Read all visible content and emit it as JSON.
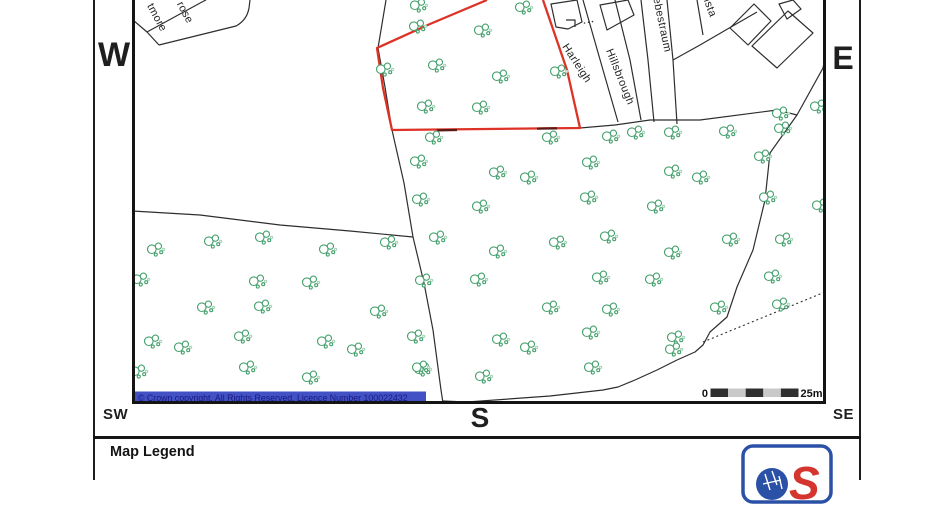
{
  "compass": {
    "west": "W",
    "east": "E",
    "south": "S",
    "southwest": "SW",
    "southeast": "SE"
  },
  "map": {
    "copyright": "© Crown copyright. All Rights Reserved. Licence Number 100022432",
    "scale_bar": {
      "start_label": "0",
      "end_label": "25m",
      "segments": 5
    },
    "street_labels": [
      {
        "text": "tmore"
      },
      {
        "text": "rose"
      },
      {
        "text": "Harleigh"
      },
      {
        "text": "Hillsbrough"
      },
      {
        "text": "Liebestraum"
      },
      {
        "text": "ista"
      }
    ],
    "colors": {
      "boundary": "#dd3327",
      "boundary_dash": "#5c1a14",
      "tree": "#44a06c",
      "tree_light": "#a8d6ba",
      "copyright_bg": "#4252c4",
      "copyright_text": "#191980",
      "scale_dark": "#2f2f2f",
      "scale_light": "#c9c9c9"
    },
    "trees": [
      [
        418,
        6
      ],
      [
        523,
        8
      ],
      [
        417,
        27
      ],
      [
        482,
        31
      ],
      [
        384,
        70
      ],
      [
        436,
        66
      ],
      [
        500,
        77
      ],
      [
        558,
        72
      ],
      [
        425,
        107
      ],
      [
        480,
        108
      ],
      [
        433,
        138
      ],
      [
        550,
        138
      ],
      [
        610,
        137
      ],
      [
        635,
        133
      ],
      [
        672,
        133
      ],
      [
        727,
        132
      ],
      [
        782,
        129
      ],
      [
        818,
        107
      ],
      [
        780,
        114
      ],
      [
        418,
        162
      ],
      [
        590,
        163
      ],
      [
        672,
        172
      ],
      [
        700,
        178
      ],
      [
        762,
        157
      ],
      [
        497,
        173
      ],
      [
        528,
        178
      ],
      [
        420,
        200
      ],
      [
        480,
        207
      ],
      [
        588,
        198
      ],
      [
        655,
        207
      ],
      [
        767,
        198
      ],
      [
        820,
        206
      ],
      [
        437,
        238
      ],
      [
        557,
        243
      ],
      [
        608,
        237
      ],
      [
        730,
        240
      ],
      [
        783,
        240
      ],
      [
        497,
        252
      ],
      [
        672,
        253
      ],
      [
        478,
        280
      ],
      [
        600,
        278
      ],
      [
        653,
        280
      ],
      [
        772,
        277
      ],
      [
        550,
        308
      ],
      [
        610,
        310
      ],
      [
        718,
        308
      ],
      [
        780,
        305
      ],
      [
        500,
        340
      ],
      [
        528,
        348
      ],
      [
        675,
        338
      ],
      [
        590,
        333
      ],
      [
        422,
        370
      ],
      [
        483,
        377
      ],
      [
        592,
        368
      ],
      [
        673,
        350
      ],
      [
        155,
        250
      ],
      [
        212,
        242
      ],
      [
        263,
        238
      ],
      [
        327,
        250
      ],
      [
        388,
        243
      ],
      [
        140,
        280
      ],
      [
        257,
        282
      ],
      [
        310,
        283
      ],
      [
        423,
        281
      ],
      [
        205,
        308
      ],
      [
        262,
        307
      ],
      [
        378,
        312
      ],
      [
        152,
        342
      ],
      [
        182,
        348
      ],
      [
        242,
        337
      ],
      [
        325,
        342
      ],
      [
        355,
        350
      ],
      [
        415,
        337
      ],
      [
        138,
        372
      ],
      [
        247,
        368
      ],
      [
        310,
        378
      ],
      [
        420,
        368
      ]
    ]
  },
  "legend": {
    "title": "Map Legend"
  },
  "logo": {
    "name": "Ordnance Survey",
    "letter_s": "S",
    "blue": "#2b51a7",
    "red": "#d5352f"
  }
}
